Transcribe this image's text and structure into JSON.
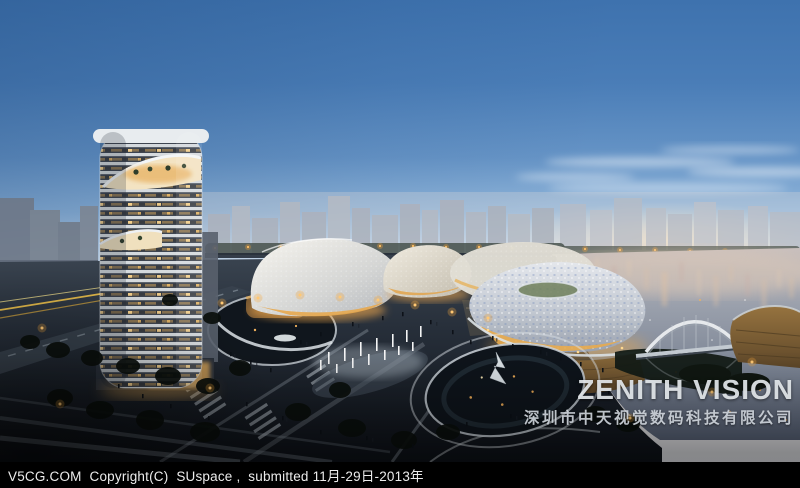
{
  "watermark": {
    "brand": "ZENITH VISION",
    "company": "深圳市中天视觉数码科技有限公司"
  },
  "footer": {
    "text": "V5CG.COM  Copyright(C)  SUspace ,  submitted 11月-29日-2013年"
  },
  "colors": {
    "sky_top": "#3e72ae",
    "sky_horizon": "#f4ece5",
    "skyline_haze": "#9aa4b2",
    "water_deep": "#5c6576",
    "plaza_dark": "#10151c",
    "warm_light": "#f0ae54",
    "tower_louver": "#d5dade",
    "wood_base": "#7c5f3a",
    "footer_bg": "#000000",
    "footer_text": "#ececec"
  }
}
